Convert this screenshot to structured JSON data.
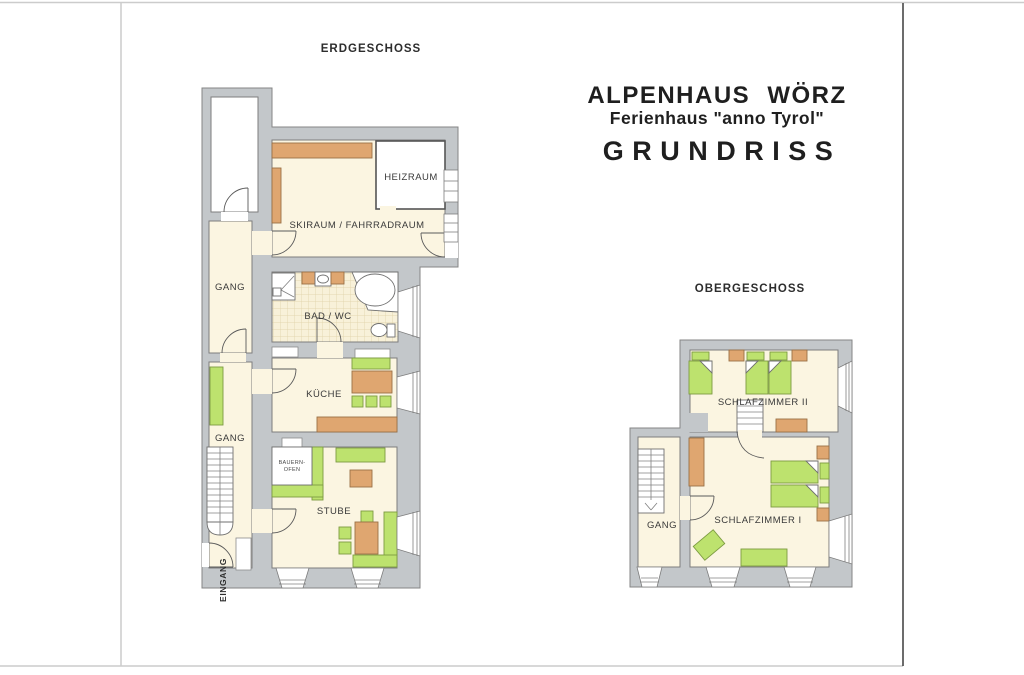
{
  "page": {
    "title_line1": "ALPENHAUS WÖRZ",
    "title_line2": "Ferienhaus \"anno Tyrol\"",
    "title_line3": "GRUNDRISS"
  },
  "floors": {
    "ground": {
      "heading": "ERDGESCHOSS",
      "rooms": {
        "skiraum": "SKIRAUM / FAHRRADRAUM",
        "heizraum": "HEIZRAUM",
        "gang_upper": "GANG",
        "bad": "BAD / WC",
        "kueche": "KÜCHE",
        "gang_lower": "GANG",
        "bauernofen_line1": "BAUERN-",
        "bauernofen_line2": "OFEN",
        "stube": "STUBE",
        "eingang": "EINGANG"
      }
    },
    "upper": {
      "heading": "OBERGESCHOSS",
      "rooms": {
        "schlafzimmer2": "SCHLAFZIMMER II",
        "schlafzimmer1": "SCHLAFZIMMER I",
        "gang": "GANG"
      }
    }
  },
  "colors": {
    "wall": "#c3c7ca",
    "room": "#fbf5e1",
    "wood": "#dfa670",
    "green": "#bde26e"
  }
}
